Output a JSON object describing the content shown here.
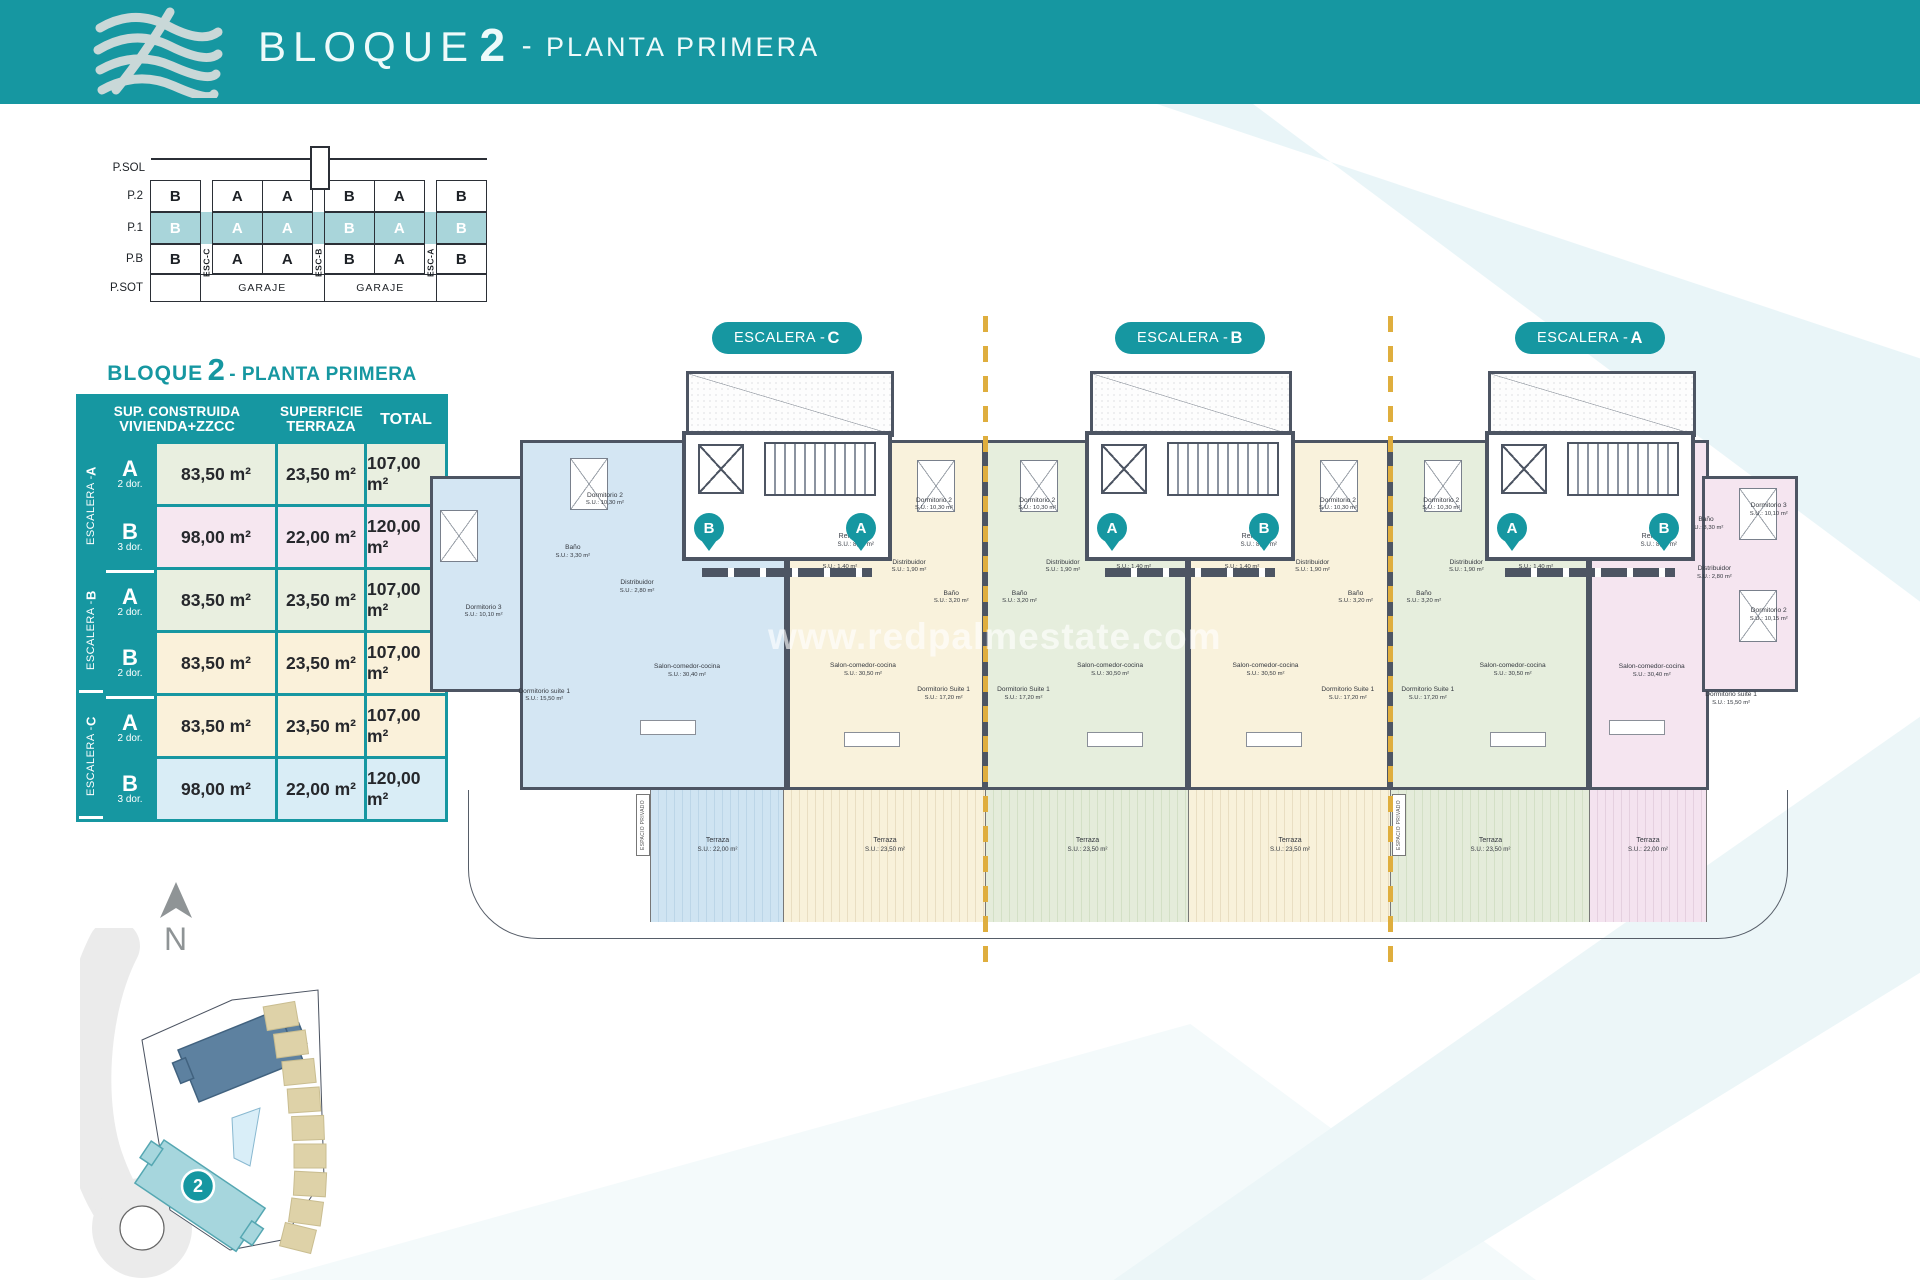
{
  "header": {
    "title_bloque": "BLOQUE",
    "title_num": "2",
    "title_dash": "-",
    "title_planta": "PLANTA PRIMERA"
  },
  "section_diagram": {
    "floors": [
      "P.SOL",
      "P.2",
      "P.1",
      "P.B",
      "P.SOT"
    ],
    "rows": {
      "p2": [
        "B",
        "A",
        "A",
        "B",
        "A",
        "B"
      ],
      "p1": [
        "B",
        "A",
        "A",
        "B",
        "A",
        "B"
      ],
      "pb": [
        "B",
        "A",
        "A",
        "B",
        "A",
        "B"
      ]
    },
    "esc": [
      "ESC-C",
      "ESC-B",
      "ESC-A"
    ],
    "garaje": [
      "GARAJE",
      "GARAJE"
    ],
    "highlight_color": "#a9d5da"
  },
  "table": {
    "title_bloque": "BLOQUE",
    "title_num": "2",
    "title_rest": " - PLANTA PRIMERA",
    "col1_l1": "SUP. CONSTRUIDA",
    "col1_l2": "VIVIENDA+ZZCC",
    "col2_l1": "SUPERFICIE",
    "col2_l2": "TERRAZA",
    "col3": "TOTAL",
    "groups": [
      {
        "esc_prefix": "ESCALERA - ",
        "esc_letter": "A",
        "rows": [
          {
            "unit": "A",
            "dorms": "2 dor.",
            "construida": "83,50 m²",
            "terraza": "23,50 m²",
            "total": "107,00 m²"
          },
          {
            "unit": "B",
            "dorms": "3 dor.",
            "construida": "98,00 m²",
            "terraza": "22,00 m²",
            "total": "120,00 m²"
          }
        ]
      },
      {
        "esc_prefix": "ESCALERA - ",
        "esc_letter": "B",
        "rows": [
          {
            "unit": "A",
            "dorms": "2 dor.",
            "construida": "83,50 m²",
            "terraza": "23,50 m²",
            "total": "107,00 m²"
          },
          {
            "unit": "B",
            "dorms": "2 dor.",
            "construida": "83,50 m²",
            "terraza": "23,50 m²",
            "total": "107,00 m²"
          }
        ]
      },
      {
        "esc_prefix": "ESCALERA - ",
        "esc_letter": "C",
        "rows": [
          {
            "unit": "A",
            "dorms": "2 dor.",
            "construida": "83,50 m²",
            "terraza": "23,50 m²",
            "total": "107,00 m²"
          },
          {
            "unit": "B",
            "dorms": "3 dor.",
            "construida": "98,00 m²",
            "terraza": "22,00 m²",
            "total": "120,00 m²"
          }
        ]
      }
    ]
  },
  "plan": {
    "pills": [
      {
        "prefix": "ESCALERA - ",
        "letter": "C"
      },
      {
        "prefix": "ESCALERA - ",
        "letter": "B"
      },
      {
        "prefix": "ESCALERA - ",
        "letter": "A"
      }
    ],
    "sections": [
      {
        "pins": [
          "B",
          "A"
        ]
      },
      {
        "pins": [
          "A",
          "B"
        ]
      },
      {
        "pins": [
          "A",
          "B"
        ]
      }
    ],
    "rellano": {
      "name": "Rellano P1",
      "area": "S.U.: 8,00 m²"
    },
    "watermark": "www.redpalmestate.com",
    "espacio": "ESPACIO PRIVADO",
    "units": [
      {
        "name": "C-B",
        "rooms": [
          {
            "n": "Dormitorio 2",
            "a": "S.U.: 10,30 m²"
          },
          {
            "n": "Dormitorio 3",
            "a": "S.U.: 10,10 m²"
          },
          {
            "n": "Baño",
            "a": "S.U.: 3,30 m²"
          },
          {
            "n": "Distribuidor",
            "a": "S.U.: 2,80 m²"
          },
          {
            "n": "Dormitorio suite 1",
            "a": "S.U.: 15,50 m²"
          },
          {
            "n": "Salon-comedor-cocina",
            "a": "S.U.: 30,40 m²"
          }
        ]
      },
      {
        "name": "C-A",
        "rooms": [
          {
            "n": "Dormitorio 2",
            "a": "S.U.: 10,30 m²"
          },
          {
            "n": "Trastero",
            "a": "S.U.: 1,40 m²"
          },
          {
            "n": "Distribuidor",
            "a": "S.U.: 1,90 m²"
          },
          {
            "n": "Baño",
            "a": "S.U.: 3,20 m²"
          },
          {
            "n": "Dormitorio Suite 1",
            "a": "S.U.: 17,20 m²"
          },
          {
            "n": "Salon-comedor-cocina",
            "a": "S.U.: 30,50 m²"
          }
        ]
      },
      {
        "name": "B-A",
        "rooms": [
          {
            "n": "Dormitorio 2",
            "a": "S.U.: 10,30 m²"
          },
          {
            "n": "Trastero",
            "a": "S.U.: 1,40 m²"
          },
          {
            "n": "Distribuidor",
            "a": "S.U.: 1,90 m²"
          },
          {
            "n": "Baño",
            "a": "S.U.: 3,20 m²"
          },
          {
            "n": "Dormitorio Suite 1",
            "a": "S.U.: 17,20 m²"
          },
          {
            "n": "Salon-comedor-cocina",
            "a": "S.U.: 30,50 m²"
          }
        ]
      },
      {
        "name": "B-B",
        "rooms": [
          {
            "n": "Dormitorio 2",
            "a": "S.U.: 10,30 m²"
          },
          {
            "n": "Trastero",
            "a": "S.U.: 1,40 m²"
          },
          {
            "n": "Distribuidor",
            "a": "S.U.: 1,90 m²"
          },
          {
            "n": "Baño",
            "a": "S.U.: 3,20 m²"
          },
          {
            "n": "Dormitorio Suite 1",
            "a": "S.U.: 17,20 m²"
          },
          {
            "n": "Salon-comedor-cocina",
            "a": "S.U.: 30,50 m²"
          }
        ]
      },
      {
        "name": "A-A",
        "rooms": [
          {
            "n": "Dormitorio 2",
            "a": "S.U.: 10,30 m²"
          },
          {
            "n": "Trastero",
            "a": "S.U.: 1,40 m²"
          },
          {
            "n": "Distribuidor",
            "a": "S.U.: 1,90 m²"
          },
          {
            "n": "Baño",
            "a": "S.U.: 3,20 m²"
          },
          {
            "n": "Dormitorio Suite 1",
            "a": "S.U.: 17,20 m²"
          },
          {
            "n": "Salon-comedor-cocina",
            "a": "S.U.: 30,50 m²"
          }
        ]
      },
      {
        "name": "A-B",
        "rooms": [
          {
            "n": "Dormitorio 2",
            "a": "S.U.: 10,15 m²"
          },
          {
            "n": "Dormitorio 3",
            "a": "S.U.: 10,10 m²"
          },
          {
            "n": "Baño",
            "a": "S.U.: 3,30 m²"
          },
          {
            "n": "Distribuidor",
            "a": "S.U.: 2,80 m²"
          },
          {
            "n": "Dormitorio suite 1",
            "a": "S.U.: 15,50 m²"
          },
          {
            "n": "Salon-comedor-cocina",
            "a": "S.U.: 30,40 m²"
          }
        ]
      }
    ],
    "terraces": [
      {
        "n": "Terraza",
        "a": "S.U.: 22,00 m²"
      },
      {
        "n": "Terraza",
        "a": "S.U.: 23,50 m²"
      },
      {
        "n": "Terraza",
        "a": "S.U.: 23,50 m²"
      },
      {
        "n": "Terraza",
        "a": "S.U.: 23,50 m²"
      },
      {
        "n": "Terraza",
        "a": "S.U.: 23,50 m²"
      },
      {
        "n": "Terraza",
        "a": "S.U.: 22,00 m²"
      }
    ]
  },
  "site": {
    "north": "N",
    "marker": "2"
  },
  "colors": {
    "teal": "#1697a1",
    "wall": "#4d5563",
    "highlight": "#a9d5da",
    "dashed": "#dfae3e",
    "unit_blue": "#d4e6f3",
    "unit_cream": "#f9f2dc",
    "unit_green": "#e6eedd",
    "unit_pink": "#f5e5f0",
    "row_green": "#e9efe0",
    "row_pink": "#f6e7f0",
    "row_cream": "#faf1da",
    "row_blue": "#d9edf6"
  }
}
